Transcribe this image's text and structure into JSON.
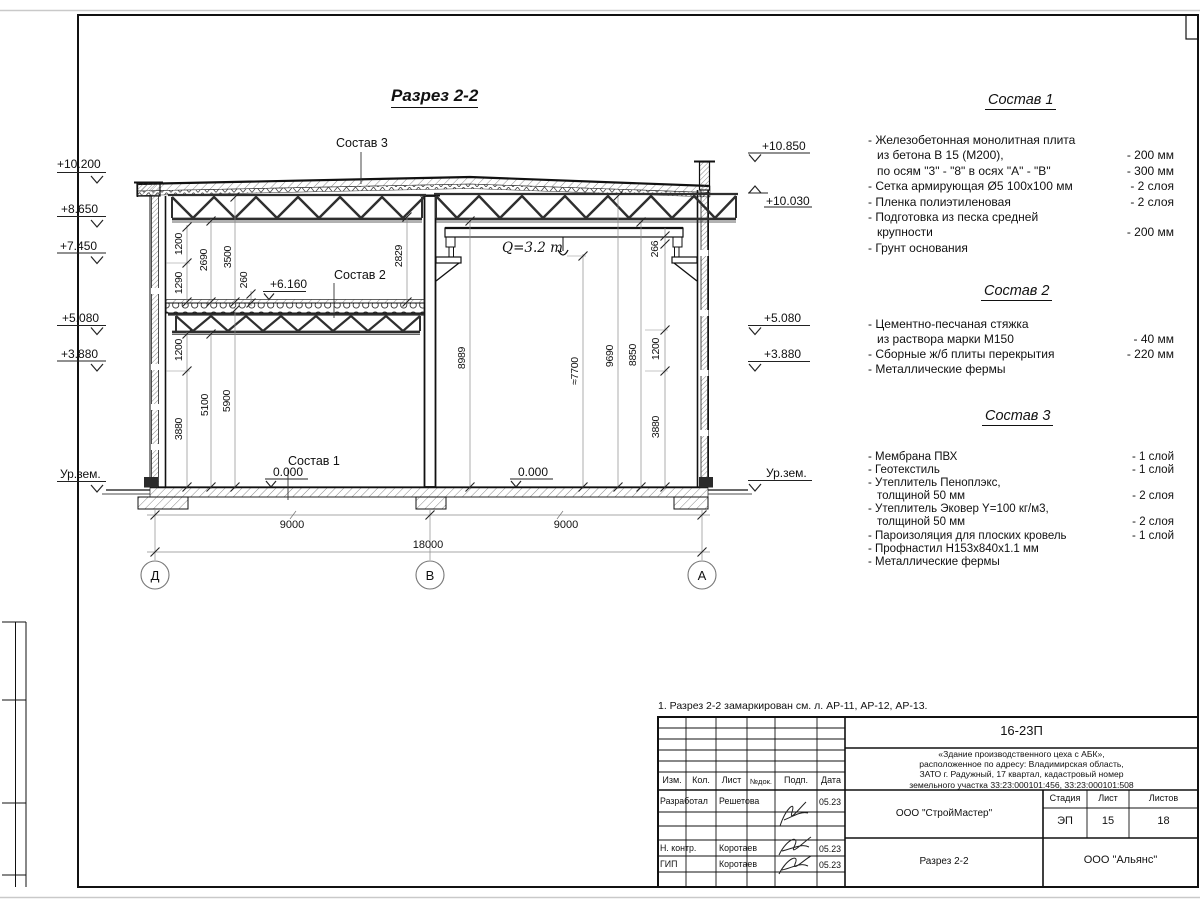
{
  "drawing": {
    "title": "Разрез 2-2",
    "crane_capacity": "Q=3.2 т",
    "leaders": {
      "s1": "Состав 1",
      "s2": "Состав 2",
      "s3": "Состав 3"
    },
    "levels": {
      "left": {
        "l1": "+10.200",
        "l2": "+8.650",
        "l3": "+7.450",
        "l4": "+5.080",
        "l5": "+3.880",
        "ground": "Ур.зем."
      },
      "right": {
        "r1": "+10.850",
        "r2": "+10.030",
        "r3": "+5.080",
        "r4": "+3.880",
        "ground": "Ур.зем."
      },
      "floor_left": "0.000",
      "floor_right": "0.000",
      "mezzanine": "+6.160"
    },
    "dims": {
      "v1": "1200",
      "v2": "1290",
      "v3": "2690",
      "v4": "3500",
      "v5": "260",
      "v6": "2829",
      "v7": "1200",
      "v8": "3880",
      "v9": "5100",
      "v10": "5900",
      "v11": "8989",
      "v12": "≈7700",
      "v13": "9690",
      "v14": "8850",
      "v15": "266",
      "v16": "1200",
      "v17": "3880",
      "h1": "9000",
      "h2": "9000",
      "h3": "18000"
    },
    "axes": {
      "a1": "Д",
      "a2": "В",
      "a3": "А"
    }
  },
  "compositions": [
    {
      "title": "Состав 1",
      "rows": [
        {
          "t": "- Железобетонная  монолитная плита",
          "v": ""
        },
        {
          "t": "из бетона В 15 (М200),",
          "v": "- 200 мм",
          "indent": true
        },
        {
          "t": "по осям \"3\" - \"8\" в осях \"А\" - \"В\"",
          "v": "- 300 мм",
          "indent": true
        },
        {
          "t": "- Сетка армирующая Ø5 100х100 мм",
          "v": "- 2 слоя"
        },
        {
          "t": "- Пленка полиэтиленовая",
          "v": "- 2 слоя"
        },
        {
          "t": "- Подготовка из песка средней",
          "v": ""
        },
        {
          "t": "крупности",
          "v": "- 200 мм",
          "indent": true
        },
        {
          "t": "- Грунт основания",
          "v": ""
        }
      ]
    },
    {
      "title": "Состав 2",
      "rows": [
        {
          "t": "- Цементно-песчаная стяжка",
          "v": ""
        },
        {
          "t": "из раствора марки М150",
          "v": "- 40 мм",
          "indent": true
        },
        {
          "t": "- Сборные ж/б плиты перекрытия",
          "v": "- 220 мм"
        },
        {
          "t": "- Металлические фермы",
          "v": ""
        }
      ]
    },
    {
      "title": "Состав 3",
      "rows": [
        {
          "t": "- Мембрана ПВХ",
          "v": "- 1 слой"
        },
        {
          "t": "- Геотекстиль",
          "v": "- 1 слой"
        },
        {
          "t": "- Утеплитель Пеноплэкс,",
          "v": ""
        },
        {
          "t": "толщиной 50 мм",
          "v": "- 2 слоя",
          "indent": true
        },
        {
          "t": "- Утеплитель Эковер Y=100 кг/м3,",
          "v": ""
        },
        {
          "t": "толщиной 50 мм",
          "v": "- 2 слоя",
          "indent": true
        },
        {
          "t": "- Пароизоляция для плоских кровель",
          "v": "- 1 слой"
        },
        {
          "t": "- Профнастил Н153х840х1.1 мм",
          "v": ""
        },
        {
          "t": "- Металлические фермы",
          "v": ""
        }
      ]
    }
  ],
  "note": "1. Разрез 2-2 замаркирован см. л. АР-11, АР-12, АР-13.",
  "titleblock": {
    "code": "16-23П",
    "object_lines": [
      "«Здание производственного цеха с АБК»,",
      "расположенное по адресу: Владимирская область,",
      "ЗАТО г. Радужный, 17 квартал, кадастровый номер",
      "земельного участка 33:23:000101:456, 33:23:000101:508"
    ],
    "columns": {
      "izm": "Изм.",
      "kol": "Кол.",
      "list": "Лист",
      "ndok": "№док.",
      "podp": "Подп.",
      "data": "Дата"
    },
    "stage_label": "Стадия",
    "sheet_label": "Лист",
    "sheets_label": "Листов",
    "stage": "ЭП",
    "sheet": "15",
    "sheets": "18",
    "org1": "ООО \"СтройМастер\"",
    "org2": "ООО \"Альянс\"",
    "doc_title": "Разрез 2-2",
    "roles": [
      {
        "role": "Разработал",
        "name": "Решетова",
        "date": "05.23"
      },
      {
        "role": "Н. контр.",
        "name": "Коротаев",
        "date": "05.23"
      },
      {
        "role": "ГИП",
        "name": "Коротаев",
        "date": "05.23"
      }
    ]
  }
}
